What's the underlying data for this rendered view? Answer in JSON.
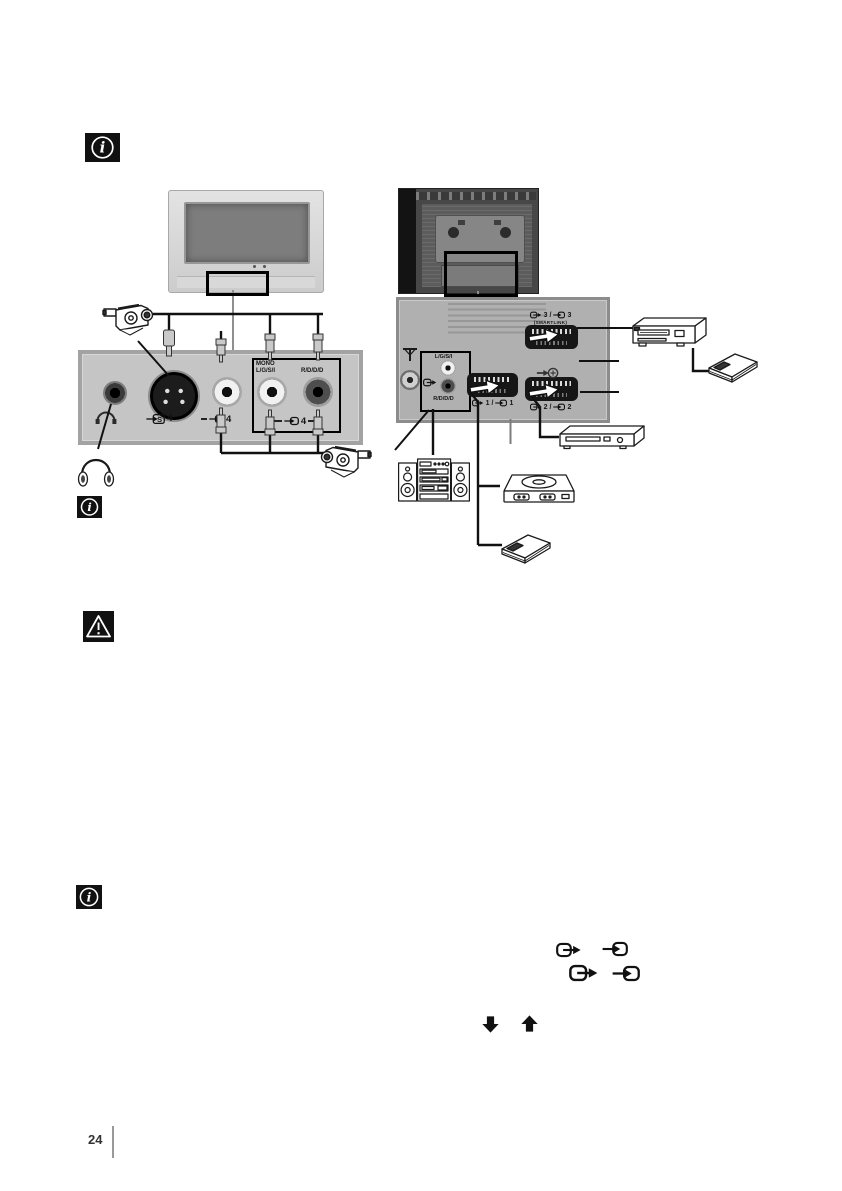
{
  "footer": {
    "page_number": "24"
  },
  "front_panel": {
    "svideo": {
      "letter": "S",
      "number": "4"
    },
    "video": {
      "number": "4"
    },
    "audio": {
      "mono": "MONO",
      "left_label": "L/G/S/I",
      "right_label": "R/D/D/D",
      "number": "4"
    }
  },
  "rear_panel": {
    "separator": "/",
    "audio_out": {
      "left_label": "L/G/S/I",
      "right_label": "R/D/D/D"
    },
    "scart1": {
      "out_number": "1",
      "in_number": "1"
    },
    "scart2": {
      "out_number": "2",
      "in_number": "2"
    },
    "scart3": {
      "out_number": "3",
      "in_number": "3",
      "smartlink": "(SMARTLINK)"
    }
  }
}
